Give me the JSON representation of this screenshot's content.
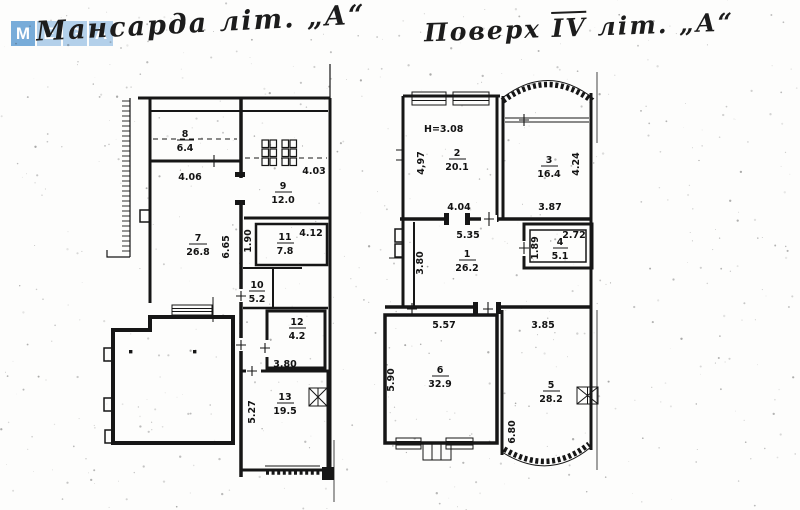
{
  "watermark": {
    "tiles": [
      "M",
      "E",
      "G",
      "A"
    ],
    "tile_color": "#b3d0ea",
    "first_tile_color": "#78acd9"
  },
  "titles": {
    "left": "Мансарда  літ. „А“",
    "right_part1": "Поверх ",
    "right_part2": "IV",
    "right_part3": " літ. „А“"
  },
  "ink_color": "#161616",
  "left_plan": {
    "rooms": {
      "r8": {
        "number": "8",
        "area": "6.4"
      },
      "r9": {
        "number": "9",
        "area": "12.0"
      },
      "r7": {
        "number": "7",
        "area": "26.8"
      },
      "r11": {
        "number": "11",
        "area": "7.8"
      },
      "r10": {
        "number": "10",
        "area": "5.2"
      },
      "r12": {
        "number": "12",
        "area": "4.2"
      },
      "r13": {
        "number": "13",
        "area": "19.5"
      }
    },
    "dims": {
      "w406": "4.06",
      "w403": "4.03",
      "w665": "6.65",
      "w190": "1.90",
      "w412": "4.12",
      "w380": "3,80",
      "w527": "5.27"
    }
  },
  "right_plan": {
    "height_note": "H=3.08",
    "rooms": {
      "r2": {
        "number": "2",
        "area": "20.1"
      },
      "r3": {
        "number": "3",
        "area": "16.4"
      },
      "r1": {
        "number": "1",
        "area": "26.2"
      },
      "r4": {
        "number": "4",
        "area": "5.1"
      },
      "r6": {
        "number": "6",
        "area": "32.9"
      },
      "r5": {
        "number": "5",
        "area": "28.2"
      }
    },
    "dims": {
      "w497": "4,97",
      "w404": "4.04",
      "w424": "4.24",
      "w387": "3.87",
      "w535": "5.35",
      "w380": "3.80",
      "w272": "2.72",
      "w189": "1.89",
      "w557": "5.57",
      "w590": "5.90",
      "w385": "3.85",
      "w680": "6.80"
    }
  }
}
